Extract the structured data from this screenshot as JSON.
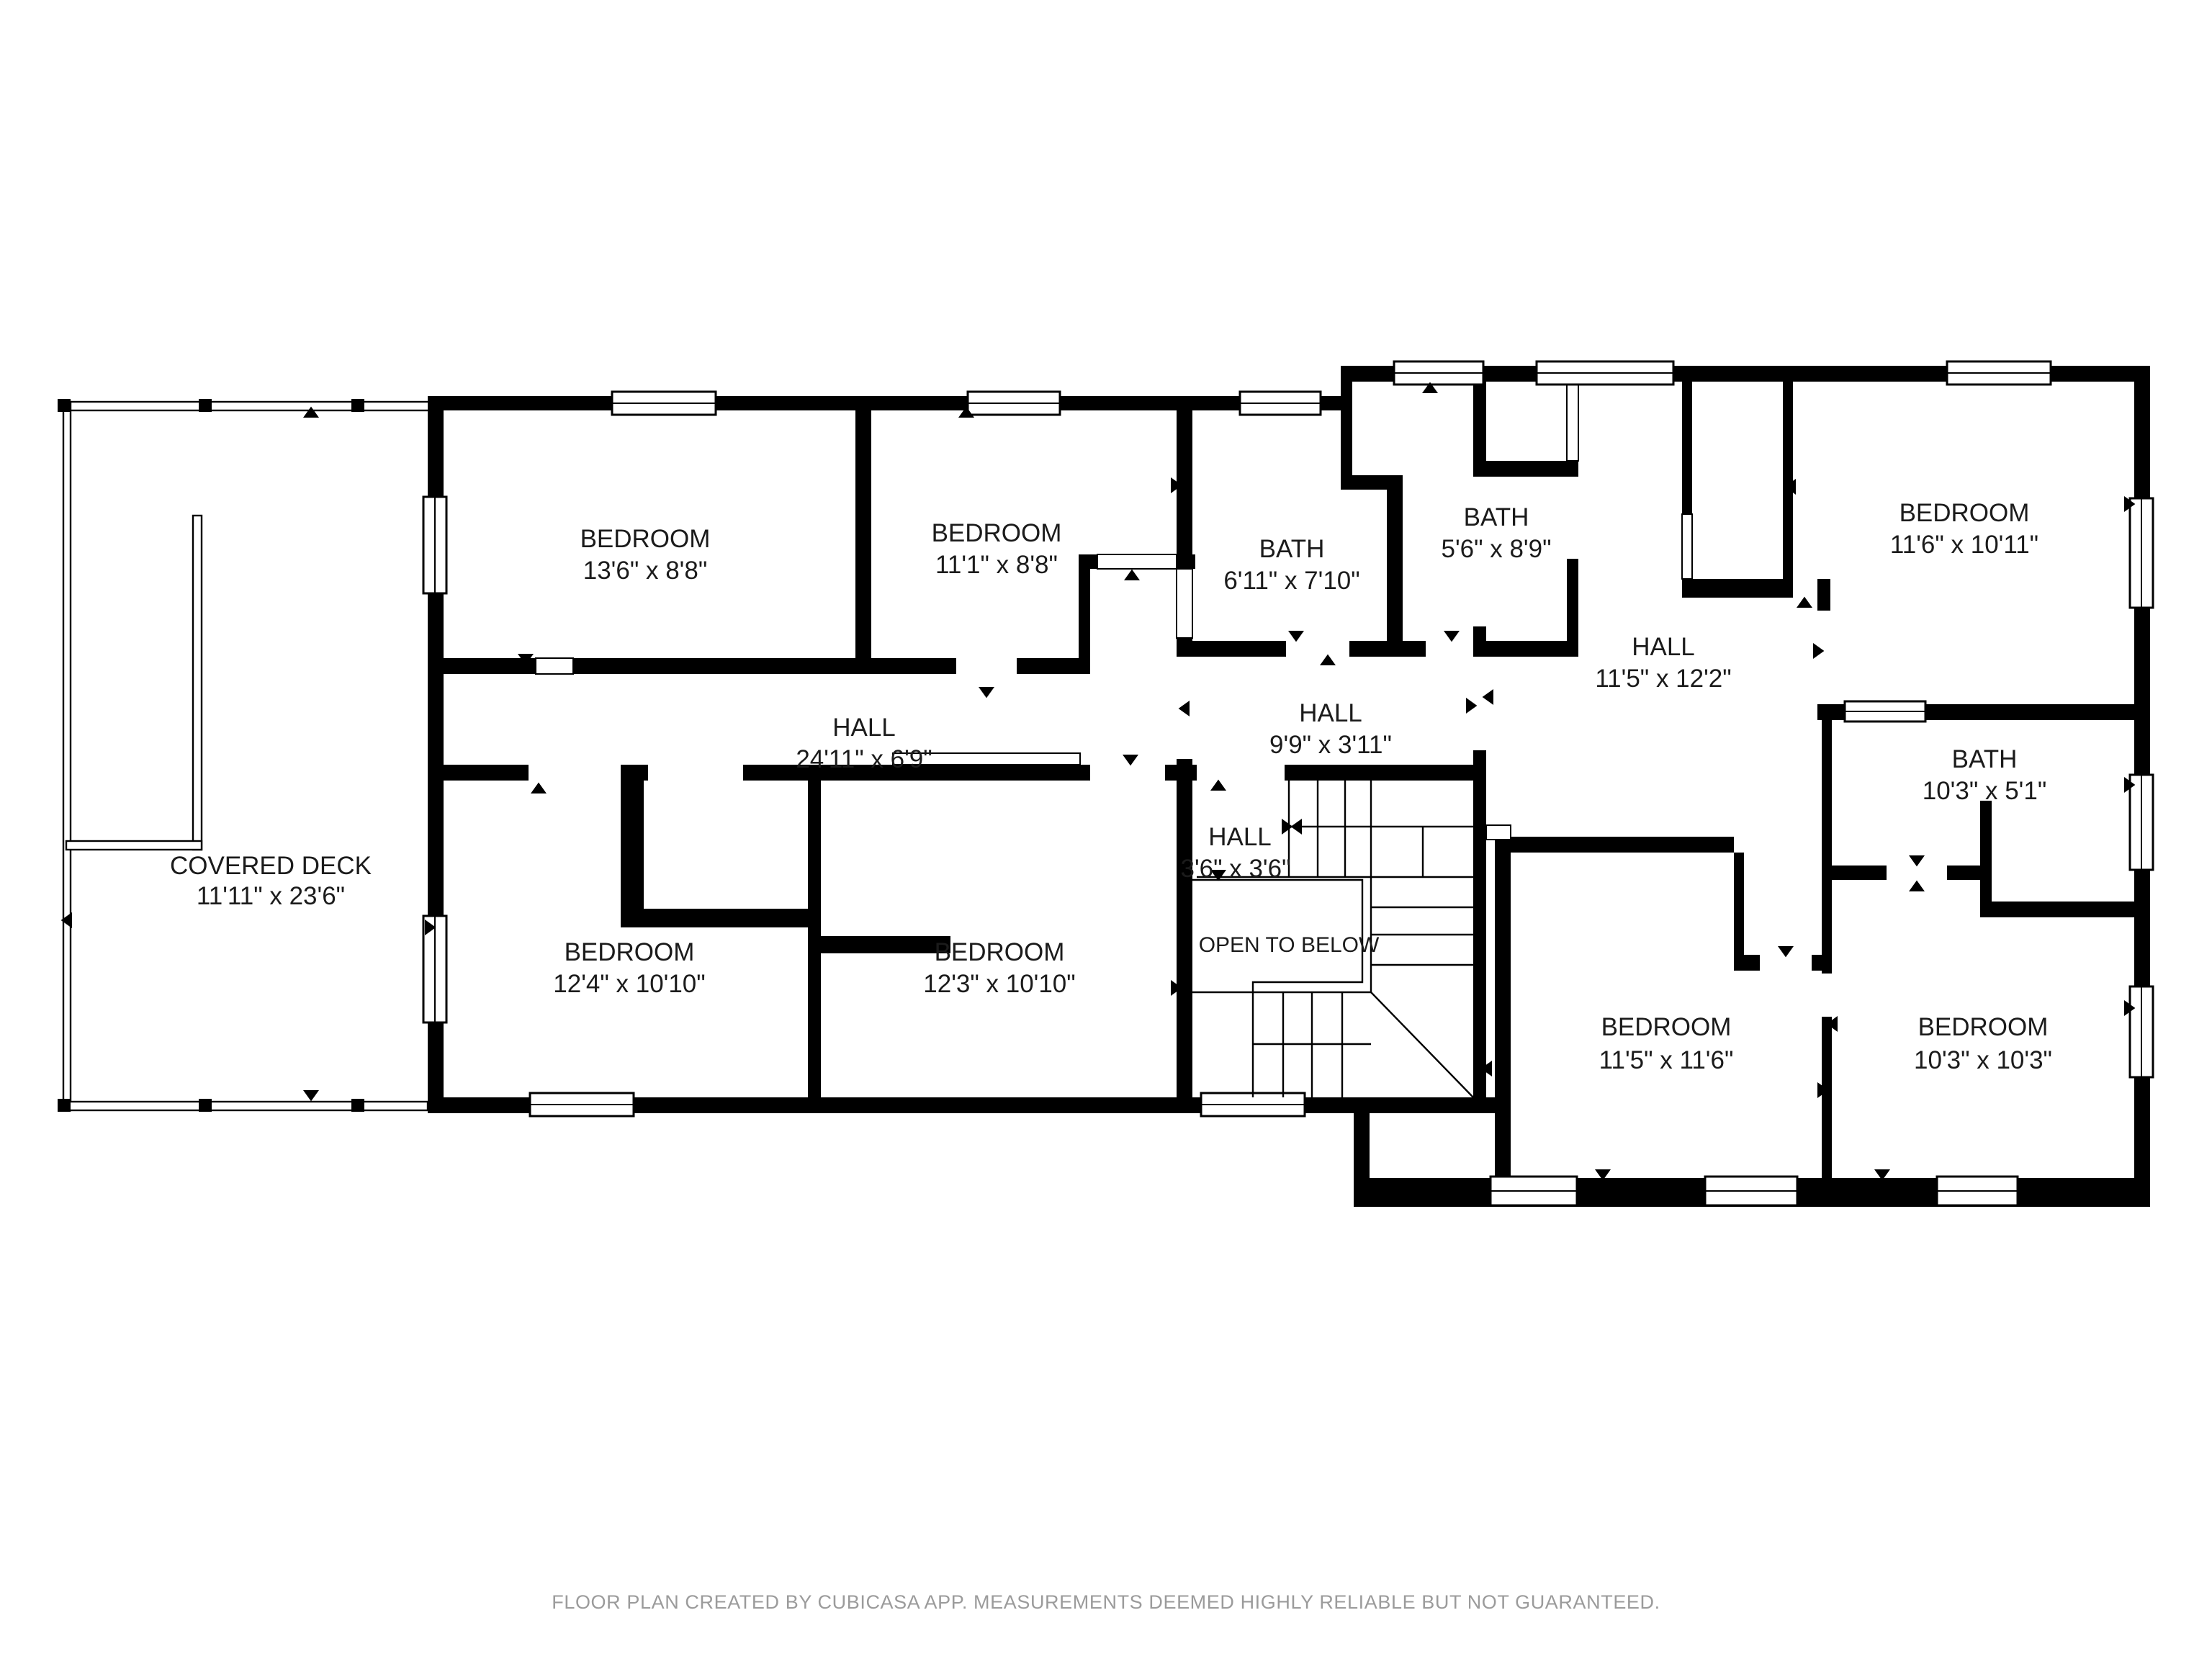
{
  "rooms": {
    "bedroom_top_left": {
      "name": "BEDROOM",
      "dims": "13'6\" x 8'8\""
    },
    "bedroom_top_mid": {
      "name": "BEDROOM",
      "dims": "11'1\" x 8'8\""
    },
    "bath_mid_left": {
      "name": "BATH",
      "dims": "6'11\" x 7'10\""
    },
    "bath_mid_right": {
      "name": "BATH",
      "dims": "5'6\" x 8'9\""
    },
    "bedroom_top_right": {
      "name": "BEDROOM",
      "dims": "11'6\" x 10'11\""
    },
    "hall_right": {
      "name": "HALL",
      "dims": "11'5\" x 12'2\""
    },
    "hall_left": {
      "name": "HALL",
      "dims": "24'11\" x 6'9\""
    },
    "hall_mid": {
      "name": "HALL",
      "dims": "9'9\" x 3'11\""
    },
    "hall_small": {
      "name": "HALL",
      "dims": "3'6\" x 3'6\""
    },
    "bath_right": {
      "name": "BATH",
      "dims": "10'3\" x 5'1\""
    },
    "covered_deck": {
      "name": "COVERED DECK",
      "dims": "11'11\" x 23'6\""
    },
    "bedroom_bot_left": {
      "name": "BEDROOM",
      "dims": "12'4\" x 10'10\""
    },
    "bedroom_bot_mid": {
      "name": "BEDROOM",
      "dims": "12'3\" x 10'10\""
    },
    "bedroom_bot_right1": {
      "name": "BEDROOM",
      "dims": "11'5\" x 11'6\""
    },
    "bedroom_bot_right2": {
      "name": "BEDROOM",
      "dims": "10'3\" x 10'3\""
    }
  },
  "annotations": {
    "open_to_below": "OPEN TO BELOW"
  },
  "footer": "FLOOR PLAN CREATED BY CUBICASA APP. MEASUREMENTS DEEMED HIGHLY RELIABLE BUT NOT GUARANTEED."
}
